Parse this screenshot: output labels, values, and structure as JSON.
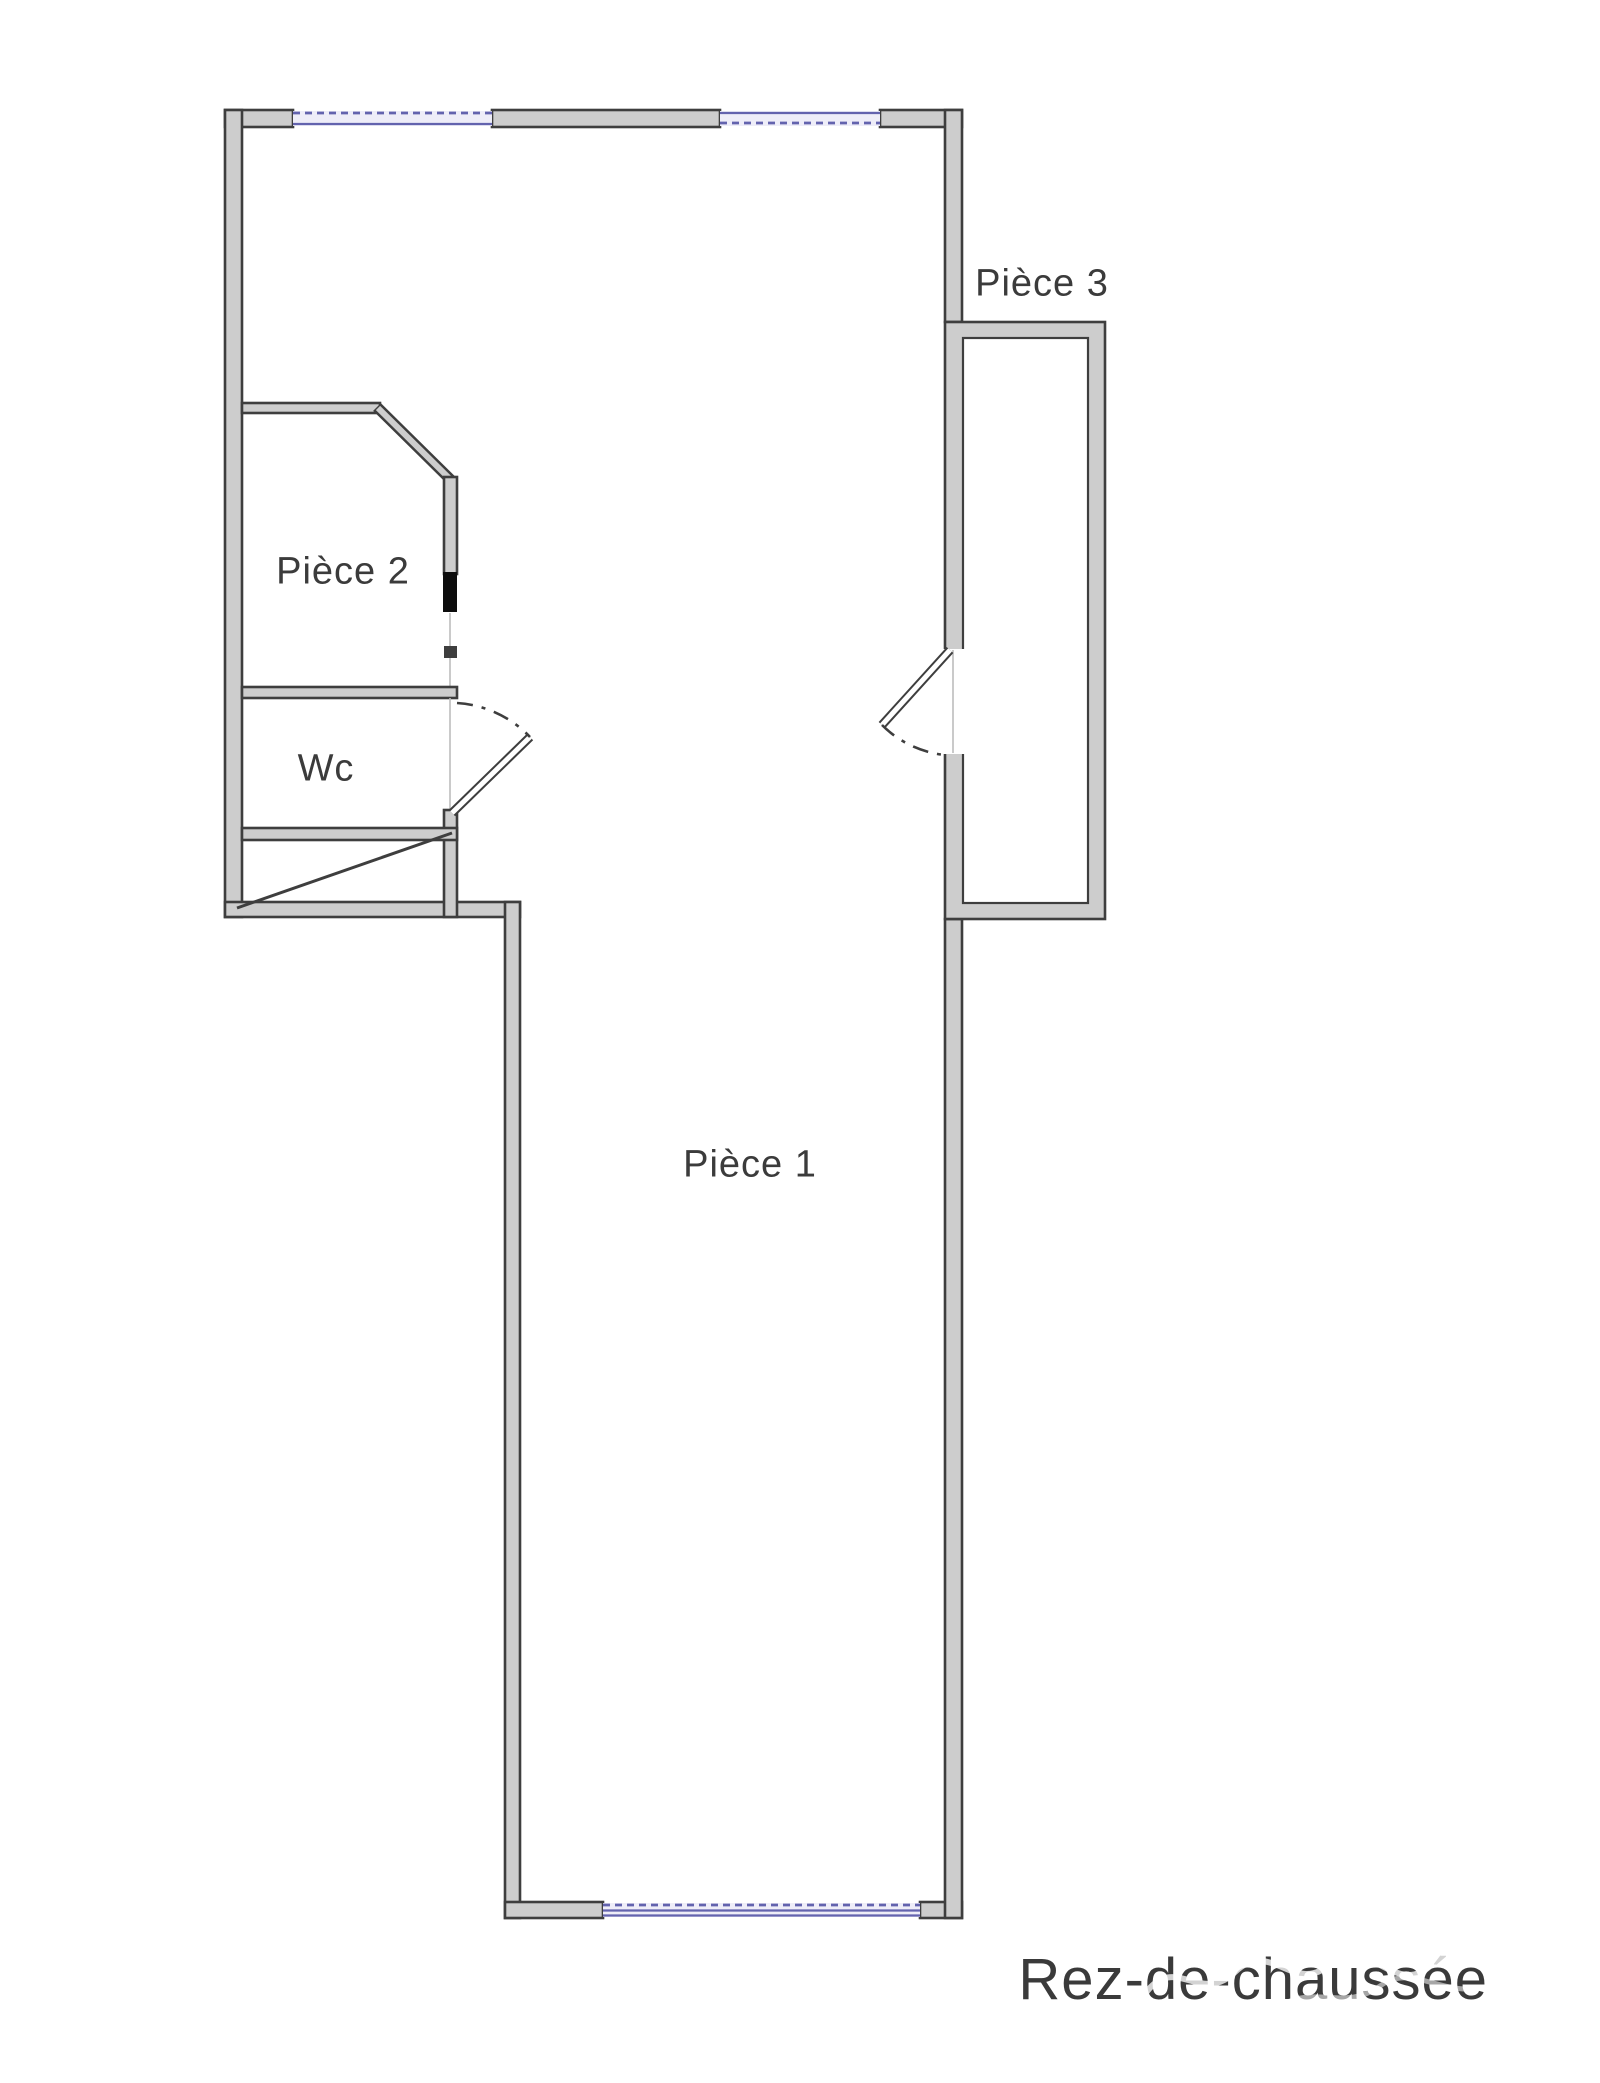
{
  "floorplan": {
    "title": "Rez-de-chaussée",
    "rooms": [
      {
        "id": "piece-1",
        "label": "Pièce 1"
      },
      {
        "id": "piece-2",
        "label": "Pièce 2"
      },
      {
        "id": "piece-3",
        "label": "Pièce 3"
      },
      {
        "id": "wc",
        "label": "Wc"
      }
    ],
    "colors": {
      "background": "#ffffff",
      "wall_fill": "#cdcdcd",
      "wall_stroke": "#3e3e3e",
      "window_fill": "#eeedf8",
      "window_accent": "#6363ae",
      "marker_black": "#0d0d0d",
      "label_text": "#3b3b3b"
    }
  }
}
